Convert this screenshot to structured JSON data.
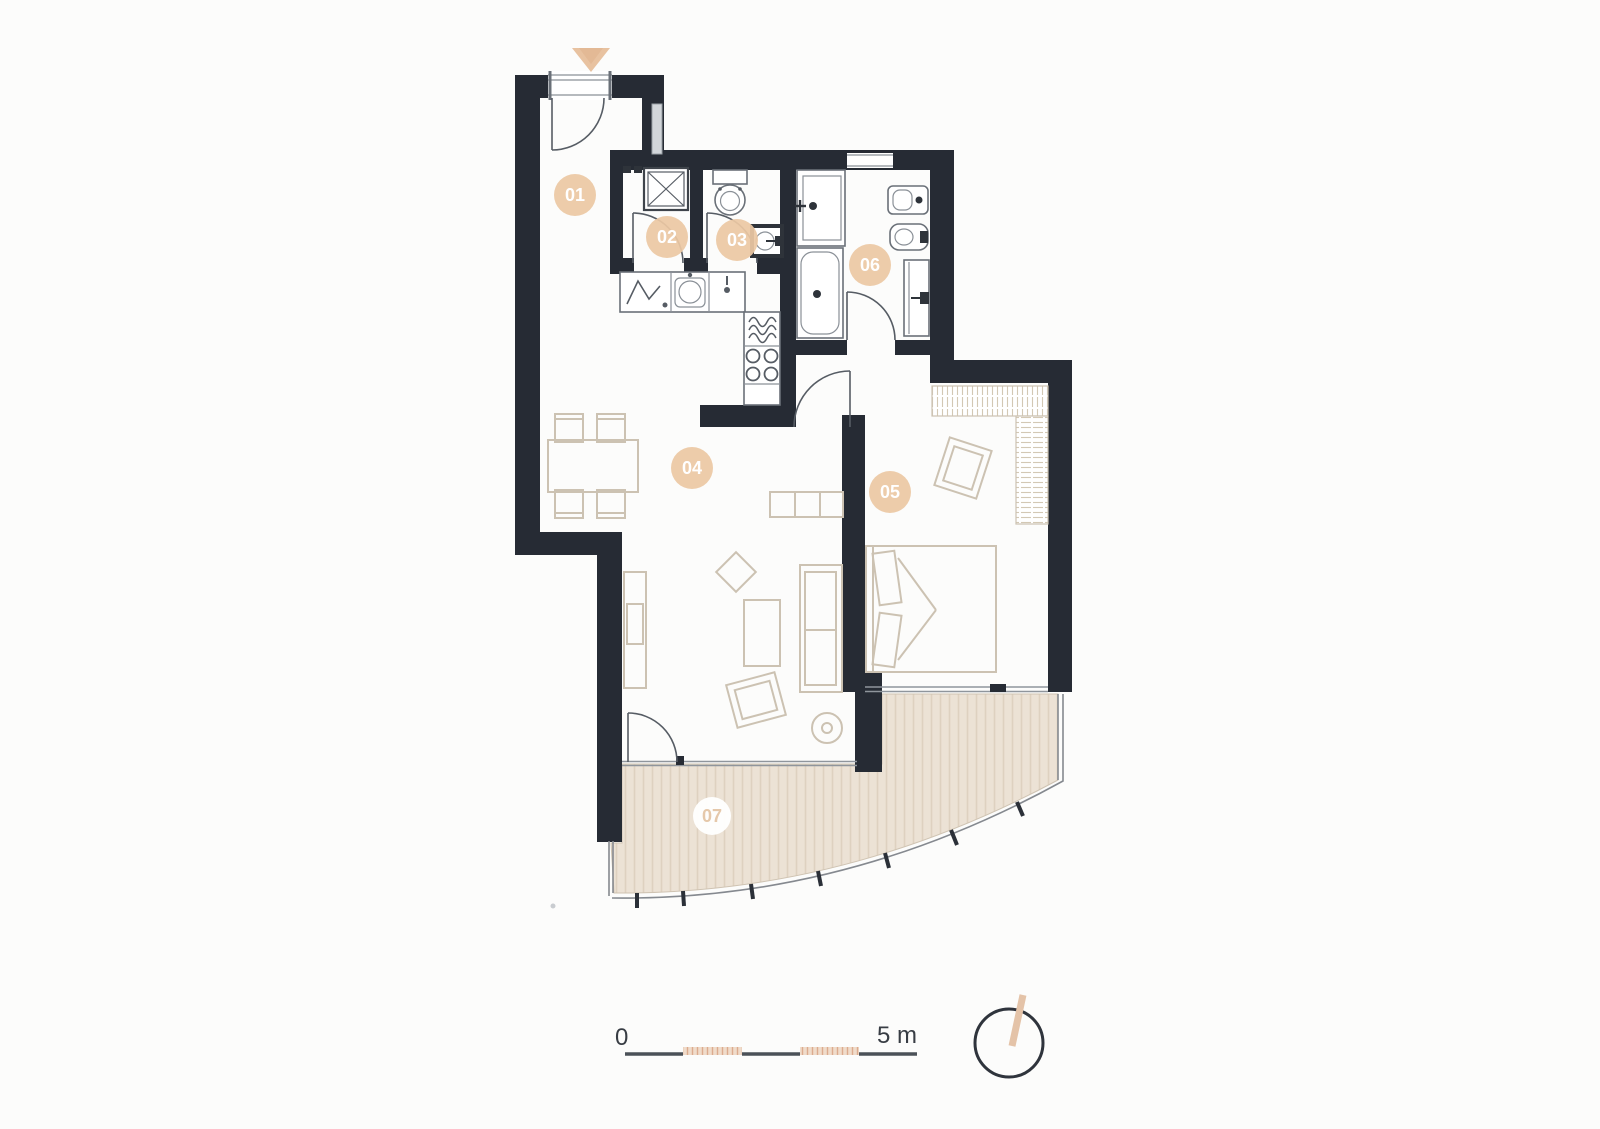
{
  "floor_plan": {
    "rooms": [
      {
        "id": "01",
        "label": "01"
      },
      {
        "id": "02",
        "label": "02"
      },
      {
        "id": "03",
        "label": "03"
      },
      {
        "id": "04",
        "label": "04"
      },
      {
        "id": "05",
        "label": "05"
      },
      {
        "id": "06",
        "label": "06"
      },
      {
        "id": "07",
        "label": "07"
      }
    ],
    "label_style": {
      "circle_fill": "#ecc8a4",
      "text_color": "#ffffff",
      "terrace_circle_fill": "#ffffff",
      "terrace_text_color": "#e5c8aa"
    },
    "colors": {
      "wall": "#262b34",
      "background": "#fcfcfb",
      "terrace_floor": "#ece2d5",
      "terrace_stripe": "#ded1c0",
      "furniture_outline": "#ccc2b2",
      "fixture_outline": "#6a7078",
      "entry_arrow": "#e8c2a0"
    },
    "icons": [
      "entry-arrow-icon",
      "entry-door-icon",
      "washing-machine-icon",
      "toilet-icon",
      "washbasin-icon",
      "fridge-icon",
      "kitchen-sink-icon",
      "dishwasher-icon",
      "stove-icon",
      "bathtub-icon",
      "bathroom-sink-icon",
      "bidet-icon",
      "dining-table-icon",
      "sofa-icon",
      "tv-cabinet-icon",
      "armchair-icon",
      "pouf-icon",
      "floor-lamp-icon",
      "double-bed-icon",
      "wardrobe-icon",
      "terrace-railing-icon",
      "compass-icon",
      "scale-bar-icon"
    ]
  },
  "scale_bar": {
    "start_label": "0",
    "end_label": "5 m"
  },
  "compass": {
    "needle_color": "#e4c3a8"
  }
}
